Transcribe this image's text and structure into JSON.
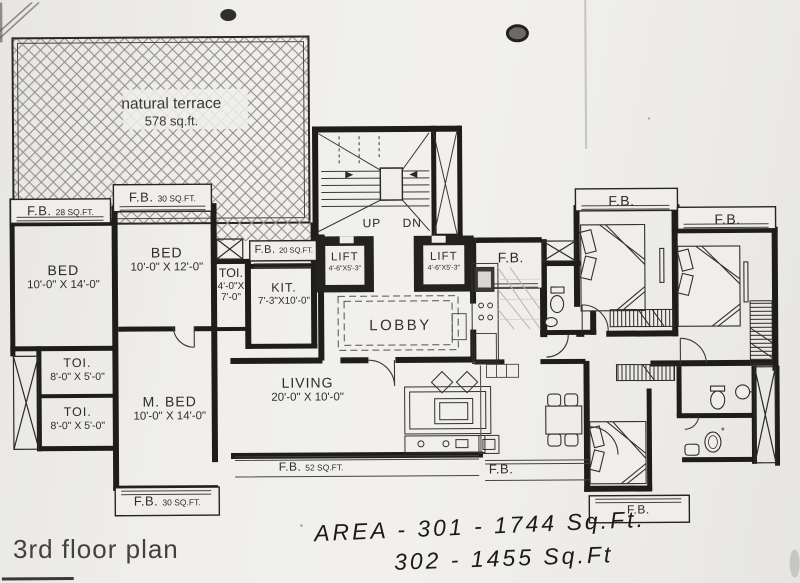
{
  "document": {
    "title": "3rd floor plan"
  },
  "handwriting": {
    "line1": "AREA - 301 - 1744 Sq.Ft.",
    "line2": "302 - 1455 Sq.Ft"
  },
  "terrace": {
    "name": "natural terrace",
    "area": "578 sq.ft."
  },
  "rooms": {
    "bed_left": {
      "name": "BED",
      "dims": "10'-0\" X 14'-0\""
    },
    "bed_mid": {
      "name": "BED",
      "dims": "10'-0\" X 12'-0\""
    },
    "toi_mid": {
      "name": "TOI.",
      "dims_line1": "4'-0\"X",
      "dims_line2": "7'-0\""
    },
    "kit": {
      "name": "KIT.",
      "dims": "7'-3\"X10'-0\""
    },
    "lobby": {
      "name": "LOBBY"
    },
    "living": {
      "name": "LIVING",
      "dims": "20'-0\" X 10'-0\""
    },
    "m_bed": {
      "name": "M. BED",
      "dims": "10'-0\" X 14'-0\""
    },
    "toi_left_top": {
      "name": "TOI.",
      "dims": "8'-0\" X 5'-0\""
    },
    "toi_left_bottom": {
      "name": "TOI.",
      "dims": "8'-0\" X 5'-0\""
    },
    "lift_left": {
      "name": "LIFT",
      "dims": "4'-6\"X5'-3\""
    },
    "lift_right": {
      "name": "LIFT",
      "dims": "4'-6\"X5'-3\""
    }
  },
  "stairs": {
    "up": "UP",
    "down": "DN"
  },
  "flower_boxes": {
    "fb_top_30": {
      "label": "F.B.",
      "area": "30 SQ.FT."
    },
    "fb_left_28": {
      "label": "F.B.",
      "area": "28 SQ.FT."
    },
    "fb_kitchen_20": {
      "label": "F.B.",
      "area": "20 SQ.FT."
    },
    "fb_living_52": {
      "label": "F.B.",
      "area": "52 SQ.FT."
    },
    "fb_bottom_30": {
      "label": "F.B.",
      "area": "30 SQ.FT."
    },
    "fb_lift": {
      "label": "F.B."
    },
    "fb_bed_top": {
      "label": "F.B."
    },
    "fb_bed_right": {
      "label": "F.B."
    },
    "fb_living_right": {
      "label": "F.B."
    },
    "fb_bottom_right": {
      "label": "F.B."
    }
  },
  "colors": {
    "ink": "#1f1d1b",
    "paper": "#efeeec"
  }
}
